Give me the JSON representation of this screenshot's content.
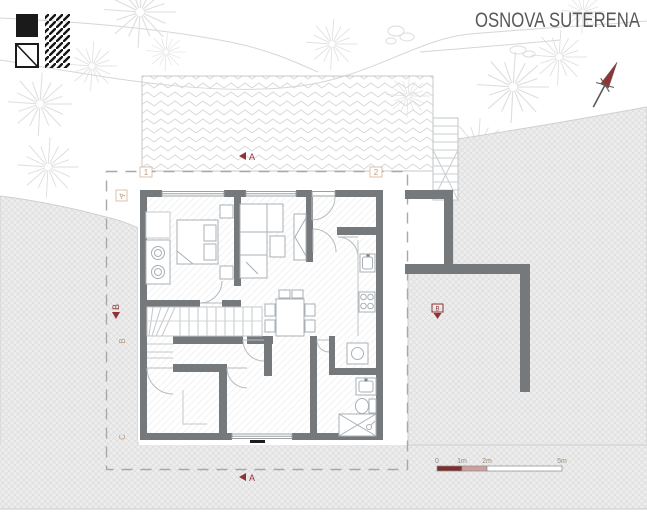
{
  "header": {
    "title": "OSNOVA SUTERENA"
  },
  "grid": {
    "column_labels": [
      "1",
      "2"
    ],
    "row_labels": [
      "A",
      "B",
      "C"
    ]
  },
  "section_markers": {
    "a_top": "A",
    "a_bottom": "A",
    "b_left": "B",
    "b_right": "B"
  },
  "scale_bar": {
    "labels": [
      "0",
      "1m",
      "2m",
      "5m"
    ]
  },
  "icons": {
    "legend_solid": "solid-square-swatch",
    "legend_diagonal": "diagonal-square-swatch",
    "legend_hatch": "hatch-swatch",
    "north": "north-arrow"
  },
  "colors": {
    "wall": "#76797b",
    "accent_red": "#8f3434",
    "grid_label": "#c29a78",
    "title": "#57585a",
    "scale_dark": "#7d2f2f",
    "scale_light": "#cf9f9f",
    "terrain": "#ededed"
  }
}
